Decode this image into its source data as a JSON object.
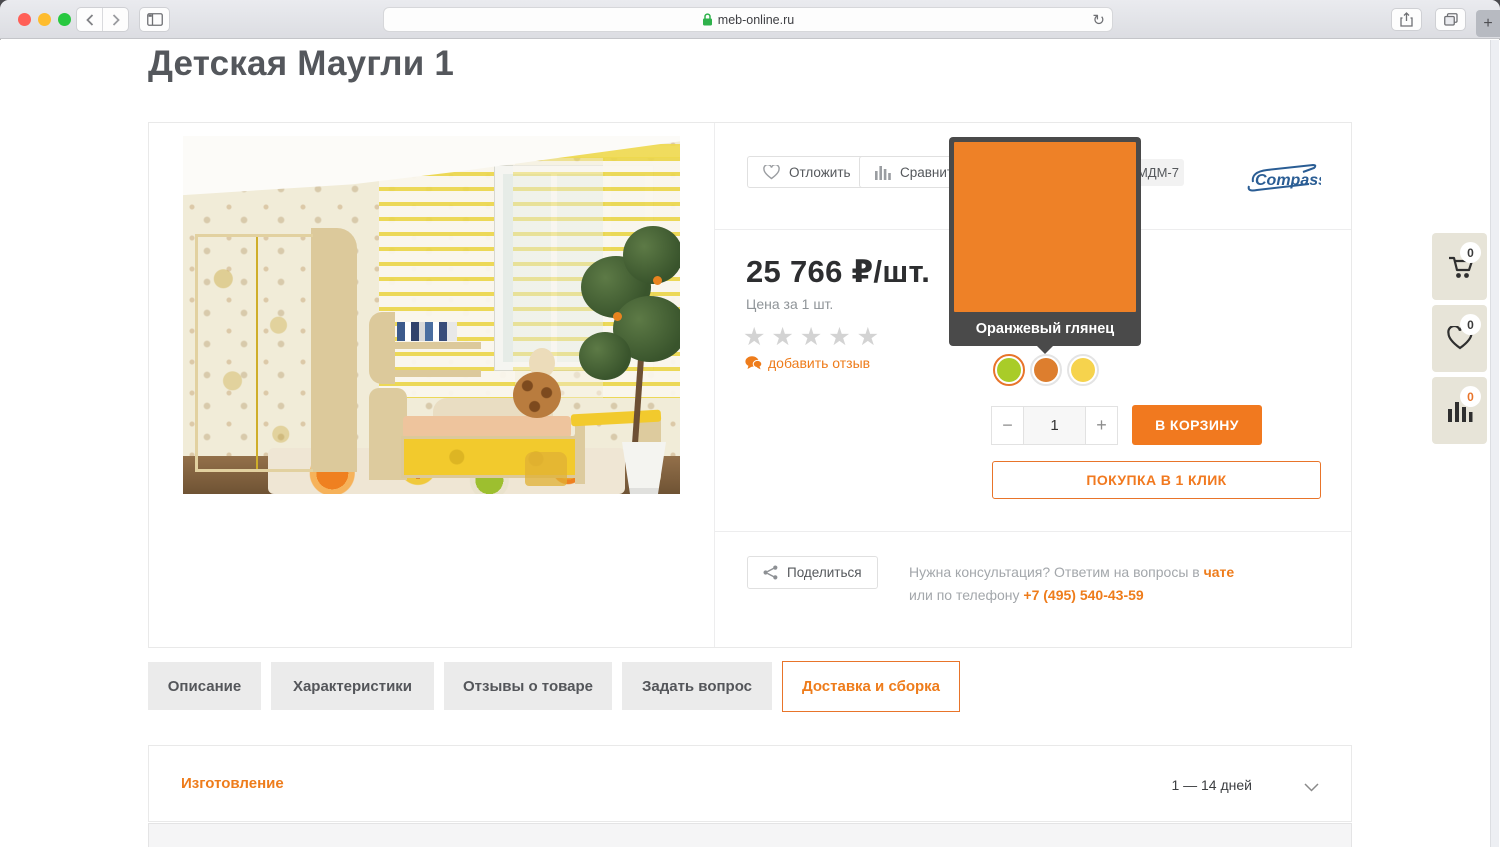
{
  "browser": {
    "url": "meb-online.ru",
    "new_tab_label": "+",
    "icons": {
      "back": "chevron-left",
      "forward": "chevron-right",
      "sidebar": "sidebar-panel",
      "lock": "padlock",
      "refresh": "reload-arrow",
      "share": "share-box-arrow",
      "tabs": "overlapping-squares"
    }
  },
  "colors": {
    "accent": "#f1791f",
    "accent_border": "#e8742a",
    "tooltip_bg": "#4a4a4a",
    "side_panel_bg": "#e7e4d8",
    "traffic_lights": [
      "#ff5f57",
      "#febc2e",
      "#28c840"
    ]
  },
  "page": {
    "title": "Детская Маугли 1"
  },
  "product": {
    "actions": {
      "defer": "Отложить",
      "compare": "Сравнить",
      "share": "Поделиться"
    },
    "sku_badge": "МДМ-7",
    "brand": "Compass",
    "price_value": "25 766",
    "price_unit": "₽/шт.",
    "price_caption": "Цена за 1 шт.",
    "rating": {
      "stars_display": "★★★★★",
      "stars_total": 5,
      "stars_filled": 0
    },
    "add_review": "добавить отзыв",
    "tooltip": {
      "label": "Оранжевый глянец",
      "color": "#ee8127"
    },
    "swatches": [
      {
        "name": "зеленый глянец",
        "color": "#a9cc28",
        "selected": true
      },
      {
        "name": "оранжевый глянец",
        "color": "#dd7e2e",
        "selected": false
      },
      {
        "name": "желтый глянец",
        "color": "#f6d34d",
        "selected": false
      }
    ],
    "quantity": {
      "minus": "−",
      "value": "1",
      "plus": "+"
    },
    "add_to_cart": "В КОРЗИНУ",
    "one_click": "ПОКУПКА В 1 КЛИК",
    "consultation": {
      "line1_prefix": "Нужна консультация? Ответим на вопросы в ",
      "chat_link": "чате",
      "line2_prefix": "или по телефону ",
      "phone": "+7 (495) 540-43-59"
    }
  },
  "tabs": [
    {
      "label": "Описание",
      "active": false
    },
    {
      "label": "Характеристики",
      "active": false
    },
    {
      "label": "Отзывы о товаре",
      "active": false
    },
    {
      "label": "Задать вопрос",
      "active": false
    },
    {
      "label": "Доставка и сборка",
      "active": true
    }
  ],
  "accordion": {
    "title": "Изготовление",
    "value": "1 — 14 дней"
  },
  "floating_buttons": [
    {
      "name": "cart",
      "count": "0"
    },
    {
      "name": "favorites",
      "count": "0"
    },
    {
      "name": "compare",
      "count": "0"
    }
  ]
}
